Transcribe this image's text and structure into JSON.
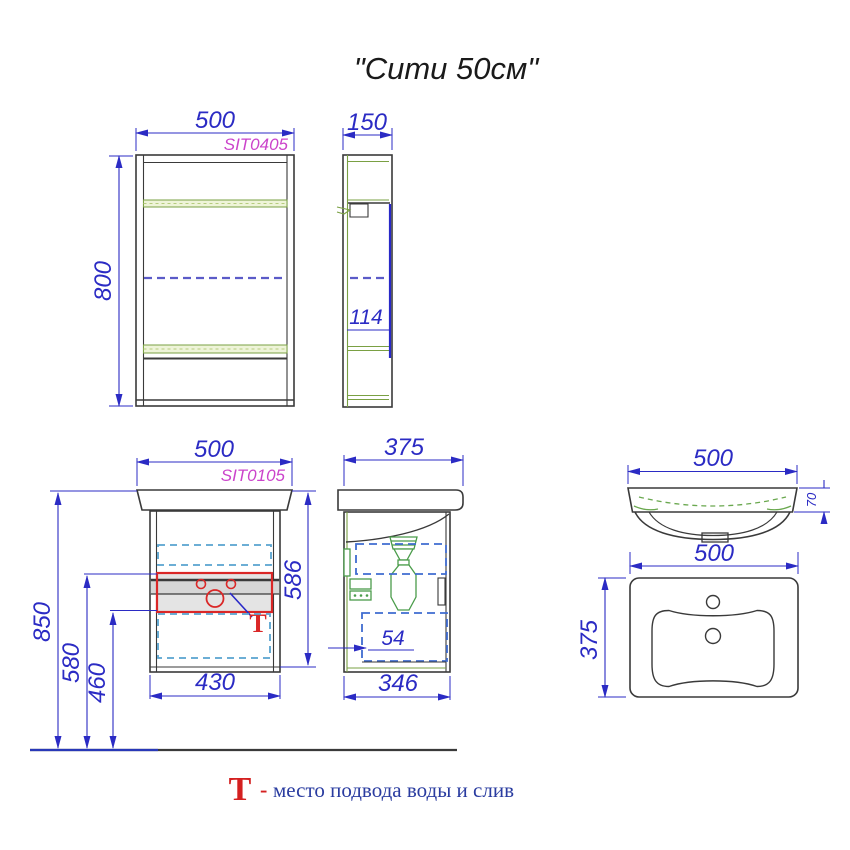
{
  "title": "\"Сити 50см\"",
  "legend": {
    "symbol": "Т",
    "dash": "-",
    "text": "место подвода воды и слив"
  },
  "mirror_front": {
    "code": "SIT0405",
    "dim_width": "500",
    "dim_height": "800"
  },
  "mirror_side": {
    "dim_depth": "150",
    "dim_inner": "114"
  },
  "vanity_front": {
    "code": "SIT0105",
    "dim_width": "500",
    "dim_h_top": "850",
    "dim_h_mid": "580",
    "dim_h_low": "460",
    "dim_body_width": "430",
    "dim_total_height": "586"
  },
  "vanity_side": {
    "dim_depth": "375",
    "dim_offset": "54",
    "dim_body_depth": "346"
  },
  "sink_front": {
    "dim_width": "500",
    "dim_rim_height": "70"
  },
  "sink_top": {
    "dim_width": "500",
    "dim_depth": "375"
  },
  "colors": {
    "dimension_blue": "#2b2bc4",
    "code_magenta": "#cb44cb",
    "drawing_dark": "#3a3a3a",
    "detail_green": "#4a9c4a",
    "shelf_green": "#7aa043",
    "drawer_dash_cyan": "#58a3cf",
    "door_dash_blue": "#5b5bc8",
    "tap_zone_red": "#da2727",
    "legend_blue": "#2a3ca0"
  }
}
